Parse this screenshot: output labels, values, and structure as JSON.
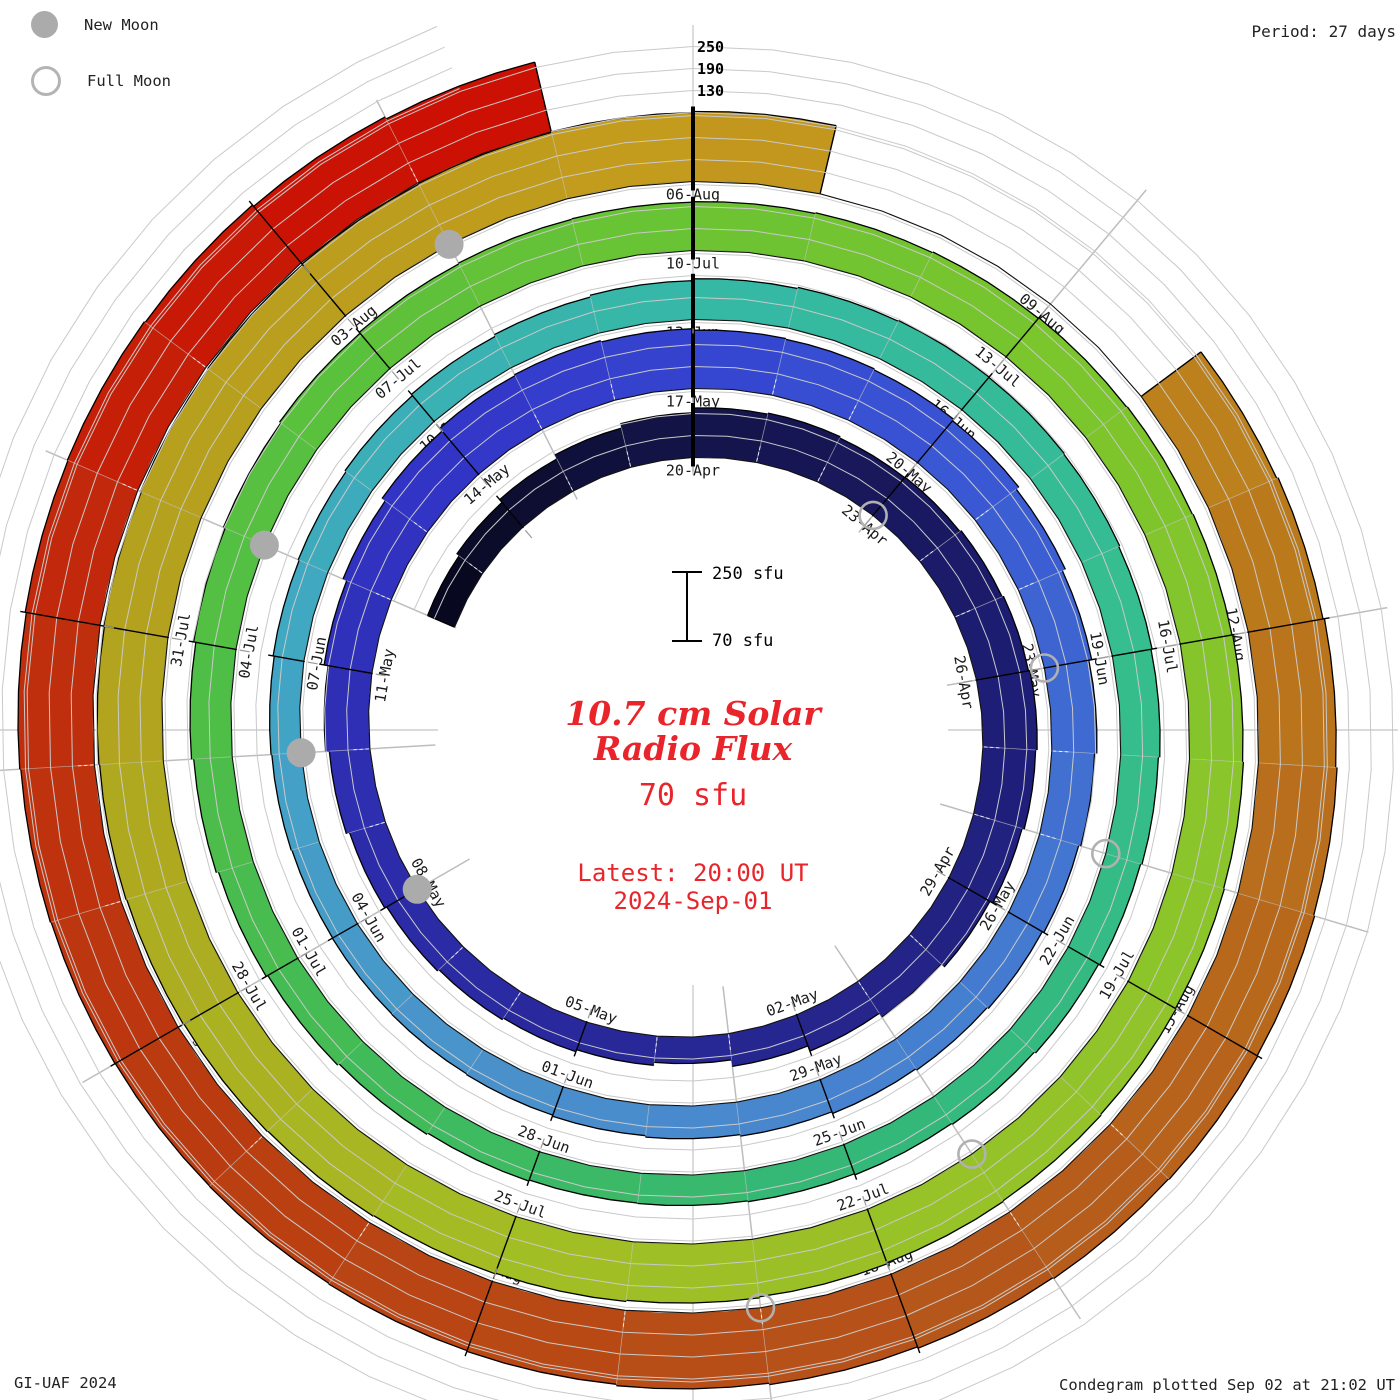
{
  "legend": {
    "new_moon": "New Moon",
    "full_moon": "Full Moon"
  },
  "header": {
    "period_label": "Period: 27 days"
  },
  "radial_axis": {
    "labels": [
      "250",
      "190",
      "130"
    ]
  },
  "scale_bar": {
    "max_label": "250 sfu",
    "min_label": "70 sfu"
  },
  "center": {
    "title_line1": "10.7 cm Solar",
    "title_line2": "Radio Flux",
    "flux_label": "70 sfu",
    "latest_line1": "Latest: 20:00 UT",
    "latest_line2": "2024-Sep-01"
  },
  "footer": {
    "left": "GI-UAF 2024",
    "right": "Condegram plotted Sep 02 at 21:02 UT"
  },
  "chart_data": {
    "type": "spiral_bar",
    "title": "10.7 cm Solar Radio Flux",
    "units": "sfu",
    "period_days": 27,
    "baseline_sfu": 70,
    "gridline_levels_sfu": [
      130,
      190,
      250
    ],
    "start_date": "2024-04-15",
    "end_date": "2024-08-31",
    "angle_zero_date": "2024-04-20",
    "daily_flux_sfu": [
      150,
      158,
      168,
      180,
      192,
      205,
      208,
      204,
      206,
      210,
      214,
      218,
      214,
      208,
      199,
      188,
      175,
      160,
      142,
      150,
      156,
      161,
      166,
      172,
      181,
      191,
      202,
      213,
      224,
      234,
      237,
      233,
      229,
      227,
      224,
      219,
      210,
      201,
      193,
      187,
      181,
      176,
      172,
      168,
      163,
      159,
      155,
      152,
      150,
      149,
      148,
      150,
      152,
      155,
      158,
      162,
      166,
      171,
      176,
      181,
      184,
      186,
      185,
      183,
      180,
      177,
      173,
      169,
      165,
      161,
      158,
      155,
      153,
      152,
      155,
      159,
      164,
      169,
      175,
      181,
      187,
      192,
      196,
      199,
      201,
      202,
      203,
      205,
      207,
      209,
      211,
      213,
      215,
      217,
      219,
      221,
      223,
      225,
      228,
      231,
      234,
      236,
      238,
      240,
      242,
      244,
      246,
      248,
      250,
      252,
      254,
      256,
      258,
      261,
      null,
      null,
      null,
      273,
      277,
      281,
      285,
      288,
      290,
      288,
      285,
      281,
      277,
      273,
      271,
      269,
      268,
      269,
      271,
      274,
      277,
      279,
      276,
      271,
      265
    ],
    "date_tick_labels": [
      "20-Apr",
      "23-Apr",
      "26-Apr",
      "29-Apr",
      "02-May",
      "05-May",
      "08-May",
      "11-May",
      "14-May",
      "17-May",
      "20-May",
      "23-May",
      "26-May",
      "29-May",
      "01-Jun",
      "04-Jun",
      "07-Jun",
      "10-Jun",
      "13-Jun",
      "16-Jun",
      "19-Jun",
      "22-Jun",
      "25-Jun",
      "28-Jun",
      "01-Jul",
      "04-Jul",
      "07-Jul",
      "10-Jul",
      "13-Jul",
      "16-Jul",
      "19-Jul",
      "22-Jul",
      "25-Jul",
      "28-Jul",
      "31-Jul",
      "03-Aug",
      "06-Aug",
      "09-Aug",
      "12-Aug",
      "15-Aug",
      "18-Aug",
      "21-Aug",
      "24-Aug",
      "27-Aug",
      "30-Aug"
    ],
    "first_label_day_index": 5,
    "tick_step_days": 3,
    "color_stops": [
      [
        0,
        "#07071c"
      ],
      [
        5,
        "#141449"
      ],
      [
        11,
        "#1d1d74"
      ],
      [
        17,
        "#26268e"
      ],
      [
        23,
        "#2b2ba8"
      ],
      [
        29,
        "#3335c8"
      ],
      [
        32,
        "#3444cf"
      ],
      [
        35,
        "#3a55d4"
      ],
      [
        41,
        "#4379d0"
      ],
      [
        47,
        "#4b8fcd"
      ],
      [
        53,
        "#41a6c3"
      ],
      [
        59,
        "#35b9a6"
      ],
      [
        65,
        "#36bd8e"
      ],
      [
        71,
        "#33b878"
      ],
      [
        77,
        "#46bb50"
      ],
      [
        83,
        "#5cc13a"
      ],
      [
        89,
        "#79c52d"
      ],
      [
        95,
        "#8ec52a"
      ],
      [
        101,
        "#a4bd25"
      ],
      [
        107,
        "#b3a21e"
      ],
      [
        113,
        "#c49a1d"
      ],
      [
        119,
        "#b9771c"
      ],
      [
        125,
        "#b5541a"
      ],
      [
        131,
        "#bb390f"
      ],
      [
        134,
        "#c02d0c"
      ],
      [
        136,
        "#c71a06"
      ],
      [
        138,
        "#cc1104"
      ]
    ],
    "moon_markers": [
      {
        "date": "23-Apr",
        "day_index": 8,
        "phase": "full"
      },
      {
        "date": "08-May",
        "day_index": 23,
        "phase": "new"
      },
      {
        "date": "23-May",
        "day_index": 38,
        "phase": "full"
      },
      {
        "date": "06-Jun",
        "day_index": 52,
        "phase": "new"
      },
      {
        "date": "21-Jun",
        "day_index": 67,
        "phase": "full"
      },
      {
        "date": "05-Jul",
        "day_index": 81,
        "phase": "new"
      },
      {
        "date": "21-Jul",
        "day_index": 97,
        "phase": "full"
      },
      {
        "date": "04-Aug",
        "day_index": 111,
        "phase": "new"
      },
      {
        "date": "19-Aug",
        "day_index": 126,
        "phase": "full"
      }
    ]
  }
}
